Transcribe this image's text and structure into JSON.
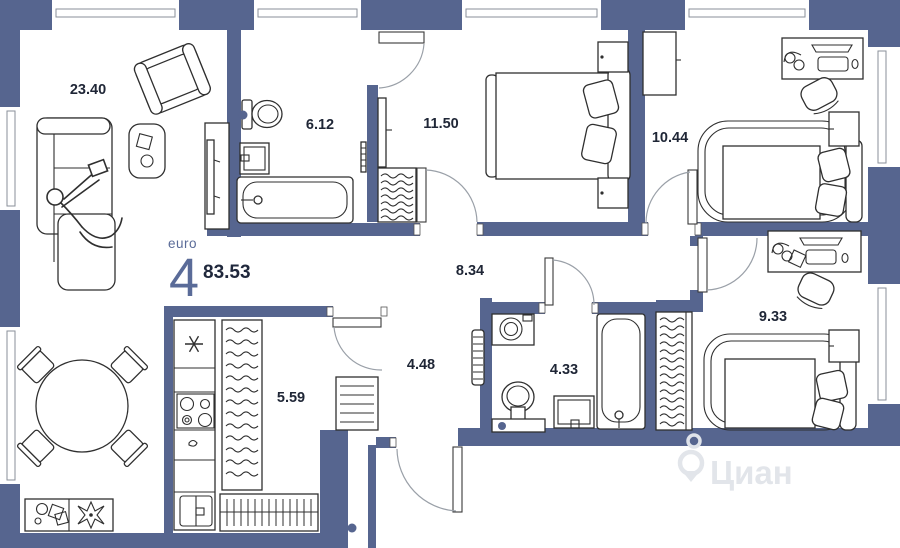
{
  "plan": {
    "unit": {
      "format_label": "euro",
      "rooms_count": "4",
      "total_area": "83.53"
    },
    "rooms": [
      {
        "name": "living-room",
        "area": "23.40"
      },
      {
        "name": "bathroom-1",
        "area": "6.12"
      },
      {
        "name": "bedroom-1",
        "area": "11.50"
      },
      {
        "name": "bedroom-2",
        "area": "10.44"
      },
      {
        "name": "hallway",
        "area": "8.34"
      },
      {
        "name": "bedroom-3",
        "area": "9.33"
      },
      {
        "name": "corridor",
        "area": "4.48"
      },
      {
        "name": "bathroom-2",
        "area": "4.33"
      },
      {
        "name": "kitchen",
        "area": "5.59"
      }
    ],
    "watermark": {
      "text": "Циан"
    },
    "colors": {
      "wall": "#56658f",
      "label": "#1f2636",
      "accent": "#5a6b98",
      "door_arc": "#9aa0a8",
      "watermark": "#e2e5ea"
    }
  }
}
